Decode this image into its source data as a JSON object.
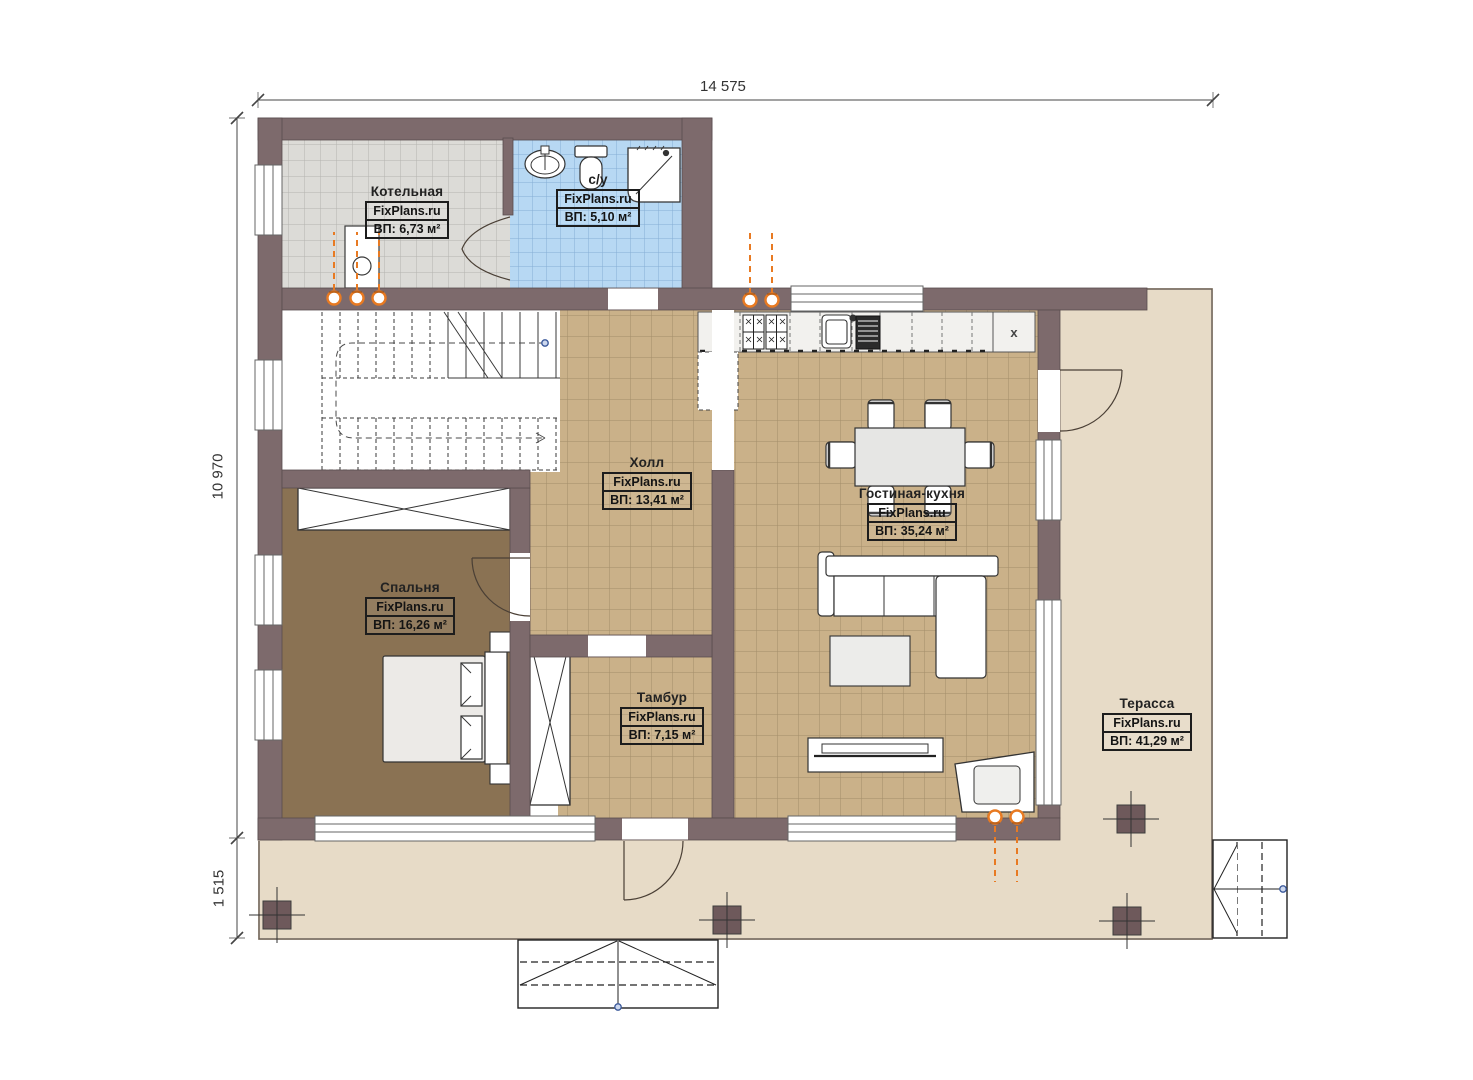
{
  "plan_title": "floor-plan-first-floor",
  "dimensions": {
    "width_top": "14 575",
    "height_left": "10 970",
    "height_bottom_left": "1 515"
  },
  "rooms": {
    "boiler": {
      "name": "Котельная",
      "brand": "FixPlans.ru",
      "area": "ВП: 6,73 м²"
    },
    "bathroom": {
      "name": "с/у",
      "brand": "FixPlans.ru",
      "area": "ВП: 5,10 м²"
    },
    "hall": {
      "name": "Холл",
      "brand": "FixPlans.ru",
      "area": "ВП: 13,41 м²"
    },
    "living": {
      "name": "Гостиная-кухня",
      "brand": "FixPlans.ru",
      "area": "ВП: 35,24 м²"
    },
    "bedroom": {
      "name": "Спальня",
      "brand": "FixPlans.ru",
      "area": "ВП: 16,26 м²"
    },
    "vestibule": {
      "name": "Тамбур",
      "brand": "FixPlans.ru",
      "area": "ВП: 7,15 м²"
    },
    "terrace": {
      "name": "Терасса",
      "brand": "FixPlans.ru",
      "area": "ВП: 41,29 м²"
    }
  },
  "kitchen": {
    "cabinet_mark": "x"
  },
  "colors": {
    "wall": "#7d6a6c",
    "floor_tile_tan": "#cab189",
    "floor_tile_gray": "#dcdbd7",
    "floor_tile_blue": "#b7d8f3",
    "floor_bedroom": "#8a7253",
    "terrace_deck": "#e7dbc7",
    "radiator_accent": "#e87a22"
  }
}
